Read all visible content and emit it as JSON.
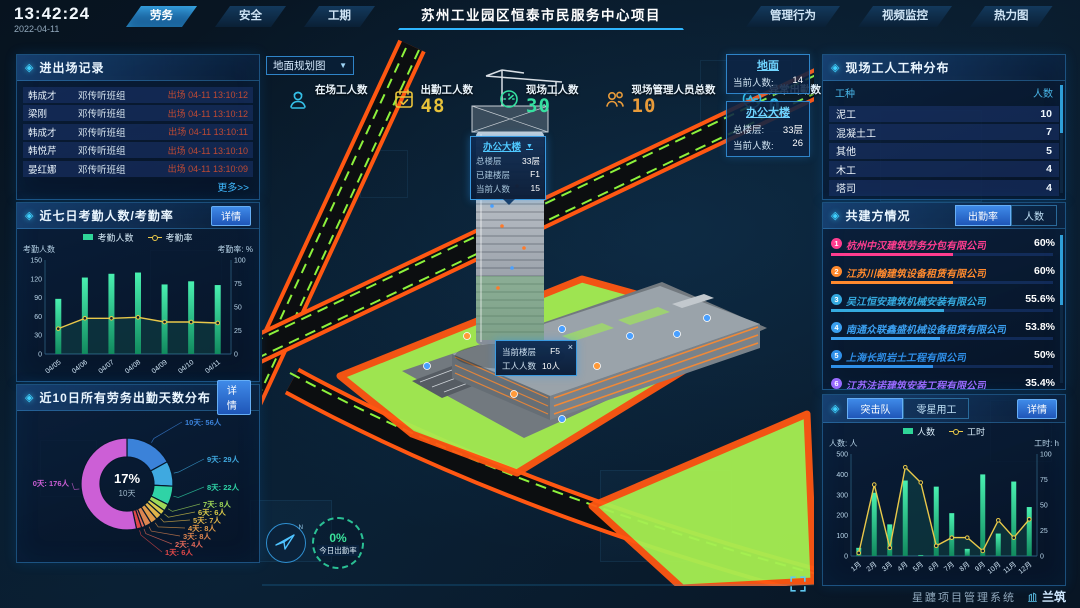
{
  "meta": {
    "time": "13:42:24",
    "date": "2022-04-11"
  },
  "topbar": {
    "title": "苏州工业园区恒泰市民服务中心项目",
    "left_tabs": [
      {
        "label": "劳务",
        "active": true
      },
      {
        "label": "安全",
        "active": false
      },
      {
        "label": "工期",
        "active": false
      }
    ],
    "right_tabs": [
      {
        "label": "管理行为",
        "active": false
      },
      {
        "label": "视频监控",
        "active": false
      },
      {
        "label": "热力图",
        "active": false
      }
    ]
  },
  "panels": {
    "entry_exit": {
      "title": "进出场记录",
      "more": "更多>>",
      "rows": [
        {
          "name": "韩成才",
          "team": "邓传听班组",
          "event": "出场 04-11 13:10:12"
        },
        {
          "name": "梁刚",
          "team": "邓传听班组",
          "event": "出场 04-11 13:10:12"
        },
        {
          "name": "韩成才",
          "team": "邓传听班组",
          "event": "出场 04-11 13:10:11"
        },
        {
          "name": "韩悦芹",
          "team": "邓传听班组",
          "event": "出场 04-11 13:10:10"
        },
        {
          "name": "晏红娜",
          "team": "邓传听班组",
          "event": "出场 04-11 13:10:09"
        }
      ]
    },
    "attendance": {
      "title": "近七日考勤人数/考勤率",
      "detail": "详情"
    },
    "distribution": {
      "title": "近10日所有劳务出勤天数分布",
      "detail": "详情"
    },
    "trades": {
      "title": "现场工人工种分布",
      "headers": [
        "工种",
        "人数"
      ],
      "rows": [
        [
          "泥工",
          "10"
        ],
        [
          "混凝土工",
          "7"
        ],
        [
          "其他",
          "5"
        ],
        [
          "木工",
          "4"
        ],
        [
          "塔司",
          "4"
        ]
      ]
    },
    "partners": {
      "title": "共建方情况",
      "tabs": [
        {
          "label": "出勤率",
          "active": true
        },
        {
          "label": "人数",
          "active": false
        }
      ],
      "rows": [
        {
          "rank": "1",
          "name": "杭州中汉建筑劳务分包有限公司",
          "value": "60%",
          "color": "#ff3d8f",
          "bar": 55
        },
        {
          "rank": "2",
          "name": "江苏川翰建筑设备租赁有限公司",
          "value": "60%",
          "color": "#ff8a2e",
          "bar": 55
        },
        {
          "rank": "3",
          "name": "吴江恒安建筑机械安装有限公司",
          "value": "55.6%",
          "color": "#35aadf",
          "bar": 51
        },
        {
          "rank": "4",
          "name": "南通众联鑫盛机械设备租赁有限公司",
          "value": "53.8%",
          "color": "#3a9ff0",
          "bar": 49
        },
        {
          "rank": "5",
          "name": "上海长凯岩土工程有限公司",
          "value": "50%",
          "color": "#2f8fe8",
          "bar": 46
        },
        {
          "rank": "6",
          "name": "江苏法诺建筑安装工程有限公司",
          "value": "35.4%",
          "color": "#9a6bff",
          "bar": 32
        }
      ]
    },
    "squad": {
      "tabs": [
        {
          "label": "突击队",
          "active": true
        },
        {
          "label": "零星用工",
          "active": false
        }
      ],
      "detail": "详情"
    }
  },
  "map": {
    "layer_select": "地面规划图",
    "stats": [
      {
        "label": "在场工人数",
        "value": "",
        "color": "#35c1e8",
        "icon": "worker-icon"
      },
      {
        "label": "出勤工人数",
        "value": "48",
        "color": "#e8c23a",
        "icon": "calendar-check-icon"
      },
      {
        "label": "现场工人数",
        "value": "30",
        "color": "#35e0a0",
        "icon": "gauge-icon"
      },
      {
        "label": "现场管理人员总数",
        "value": "10",
        "color": "#e89b3a",
        "icon": "people-icon"
      },
      {
        "label": "异常出勤数",
        "value": "0",
        "color": "#35c1e8",
        "icon": "pulse-icon"
      }
    ],
    "building_tooltip": {
      "title": "办公大楼",
      "rows": [
        [
          "总楼层",
          "33层"
        ],
        [
          "已建楼层",
          "F1"
        ],
        [
          "当前人数",
          "15"
        ]
      ]
    },
    "floor_tooltip": {
      "rows": [
        [
          "当前楼层",
          "F5"
        ],
        [
          "工人人数",
          "10人"
        ]
      ],
      "close": "×"
    },
    "area_cards": [
      {
        "title": "地面",
        "rows": [
          [
            "当前人数:",
            "14"
          ]
        ]
      },
      {
        "title": "办公大楼",
        "rows": [
          [
            "总楼层:",
            "33层"
          ],
          [
            "当前人数:",
            "26"
          ]
        ]
      }
    ],
    "gauge": {
      "value": "0%",
      "label": "今日出勤率"
    }
  },
  "footer": {
    "system": "星躔项目管理系统",
    "logo": "兰筑"
  },
  "chart_data": [
    {
      "id": "attendance",
      "type": "bar+line",
      "title": "近七日考勤人数/考勤率",
      "categories": [
        "04/05",
        "04/06",
        "04/07",
        "04/08",
        "04/09",
        "04/10",
        "04/11"
      ],
      "series": [
        {
          "name": "考勤人数",
          "type": "bar",
          "axis": "left",
          "color": "#2fd598",
          "values": [
            88,
            122,
            128,
            130,
            111,
            116,
            110
          ]
        },
        {
          "name": "考勤率",
          "type": "line",
          "axis": "right",
          "color": "#e9c84a",
          "values": [
            27,
            38,
            38,
            39,
            34,
            34,
            33
          ]
        }
      ],
      "left_axis": {
        "label": "考勤人数",
        "ticks": [
          0,
          30,
          60,
          90,
          120,
          150
        ],
        "max": 150
      },
      "right_axis": {
        "label": "考勤率: %",
        "ticks": [
          0,
          25,
          50,
          75,
          100
        ],
        "max": 100
      },
      "legend_position": "top",
      "grid": false
    },
    {
      "id": "distribution",
      "type": "pie",
      "title": "近10日所有劳务出勤天数分布",
      "center_label": {
        "pct": "17%",
        "name": "10天"
      },
      "slices": [
        {
          "name": "10天",
          "people": 56,
          "label": "10天: 56人",
          "color": "#3b82d9"
        },
        {
          "name": "9天",
          "people": 29,
          "label": "9天: 29人",
          "color": "#3fa9e0"
        },
        {
          "name": "8天",
          "people": 22,
          "label": "8天: 22人",
          "color": "#2fd3a6"
        },
        {
          "name": "7天",
          "people": 8,
          "label": "7天: 8人",
          "color": "#9fd858"
        },
        {
          "name": "6天",
          "people": 6,
          "label": "6天: 6人",
          "color": "#d9c94a"
        },
        {
          "name": "5天",
          "people": 7,
          "label": "5天: 7人",
          "color": "#e0b44a"
        },
        {
          "name": "4天",
          "people": 8,
          "label": "4天: 8人",
          "color": "#e09a4a"
        },
        {
          "name": "3天",
          "people": 8,
          "label": "3天: 8人",
          "color": "#dd8550"
        },
        {
          "name": "2天",
          "people": 4,
          "label": "2天: 4人",
          "color": "#e2695a"
        },
        {
          "name": "1天",
          "people": 6,
          "label": "1天: 6人",
          "color": "#e04848"
        },
        {
          "name": "0天",
          "people": 176,
          "label": "0天: 176人",
          "color": "#cc5fd6"
        }
      ]
    },
    {
      "id": "squad",
      "type": "bar+line",
      "title": "突击队",
      "categories": [
        "1月",
        "2月",
        "3月",
        "4月",
        "5月",
        "6月",
        "7月",
        "8月",
        "9月",
        "10月",
        "11月",
        "12月"
      ],
      "series": [
        {
          "name": "人数",
          "type": "bar",
          "axis": "left",
          "color": "#2fd598",
          "values": [
            40,
            310,
            155,
            370,
            5,
            340,
            210,
            35,
            400,
            110,
            365,
            240
          ]
        },
        {
          "name": "工时",
          "type": "line",
          "axis": "right",
          "color": "#e9c84a",
          "values": [
            3,
            70,
            8,
            87,
            72,
            10,
            18,
            18,
            5,
            35,
            18,
            36
          ]
        }
      ],
      "left_axis": {
        "label": "人数: 人",
        "ticks": [
          0,
          100,
          200,
          300,
          400,
          500
        ],
        "max": 500
      },
      "right_axis": {
        "label": "工时: h",
        "ticks": [
          0,
          25,
          50,
          75,
          100
        ],
        "max": 100
      },
      "legend_position": "top",
      "grid": false
    }
  ]
}
